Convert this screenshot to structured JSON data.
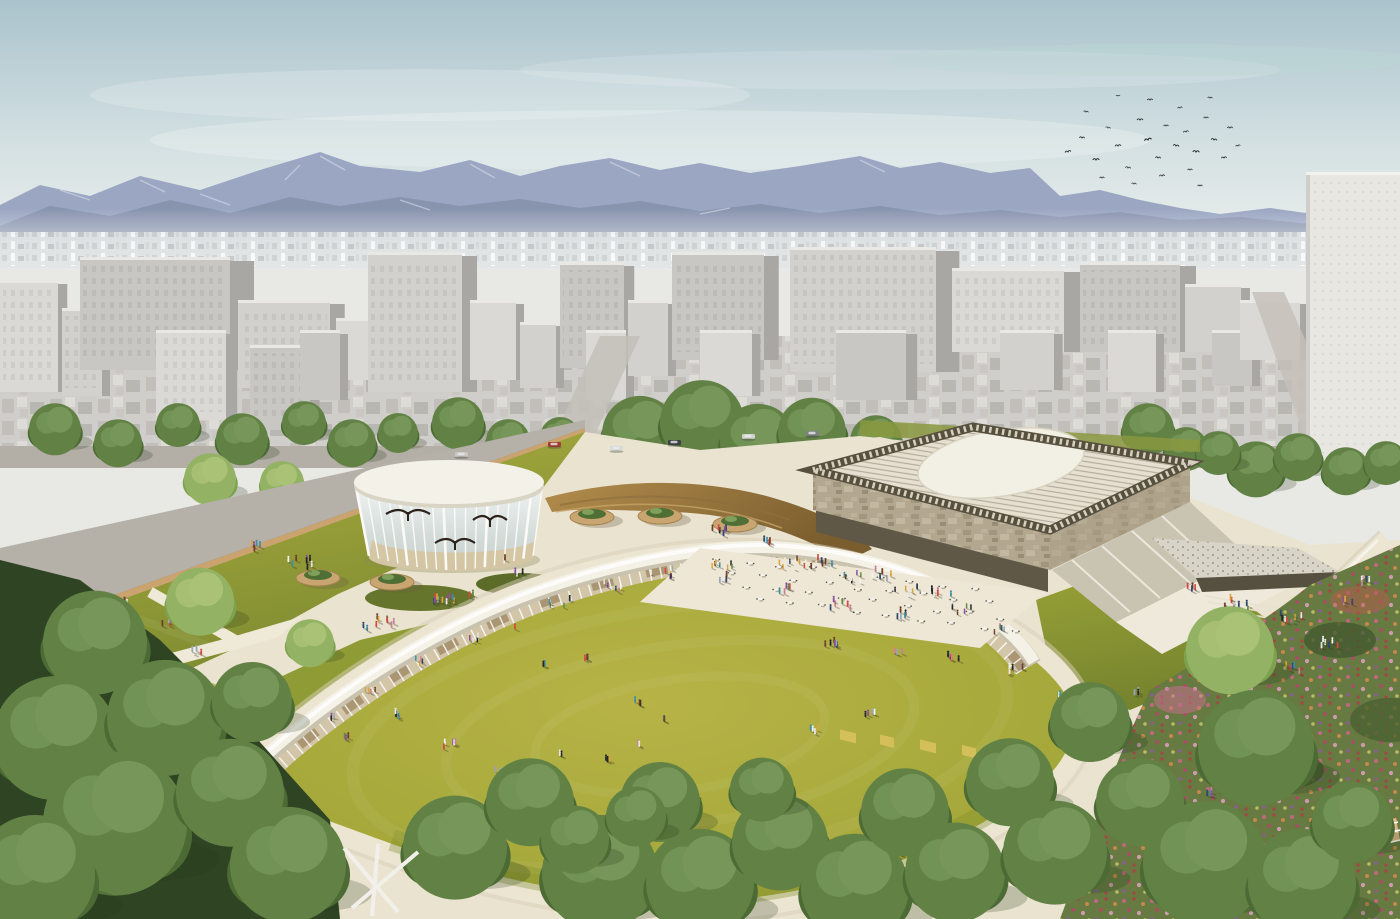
{
  "meta": {
    "width": 1400,
    "height": 919
  },
  "palette": {
    "sky_top": "#aac3cc",
    "sky_horizon": "#eef0ee",
    "mountain_far": "#9aa6c2",
    "mountain_near": "#8893ae",
    "city_face": "#d7d6d2",
    "city_side": "#a9a7a3",
    "city_lowrise": "#c9c7c2",
    "tower_right": "#e8e7e2",
    "lawn_sunken": "#a5a83a",
    "lawn_field": "#99a338",
    "green_roof": "#8f9c36",
    "plaza_cream": "#eae3cf",
    "path_cream": "#ece5d1",
    "fascia_white": "#f4f1e6",
    "gallery_glass_tan": "#d3c6a8",
    "ochre_ramp": "#a5813f",
    "museum_roof": "#e6e0d0",
    "museum_circle": "#f2efe4",
    "museum_stone": "#b3a78f",
    "truss_dark": "#57503e",
    "tree_dark": "#3f5a2c",
    "tree_mid": "#577539",
    "tree_light": "#6f8f48",
    "flower_pink": "#c9648b",
    "flower_red": "#a84343",
    "flower_orange": "#d08a4e",
    "wall_brown": "#8a7450"
  },
  "scene": {
    "people_palette": [
      "#d24a42",
      "#30476e",
      "#e8e7e3",
      "#26262b",
      "#d9a33b",
      "#5f8a49",
      "#8a4f9e",
      "#c97f97",
      "#3d8fa6",
      "#f2f2ef",
      "#6b3f27",
      "#9aa6b8"
    ],
    "city_buildings": [
      [
        0,
        58,
        280,
        392
      ],
      [
        62,
        40,
        308,
        396
      ],
      [
        80,
        150,
        257,
        370
      ],
      [
        156,
        70,
        330,
        420
      ],
      [
        238,
        92,
        300,
        388
      ],
      [
        250,
        60,
        345,
        430
      ],
      [
        336,
        34,
        318,
        380
      ],
      [
        368,
        94,
        252,
        392
      ],
      [
        300,
        40,
        330,
        400
      ],
      [
        470,
        46,
        300,
        380
      ],
      [
        520,
        36,
        322,
        388
      ],
      [
        560,
        64,
        262,
        368
      ],
      [
        586,
        40,
        330,
        400
      ],
      [
        628,
        40,
        300,
        376
      ],
      [
        672,
        92,
        252,
        360
      ],
      [
        700,
        52,
        330,
        396
      ],
      [
        790,
        146,
        247,
        372
      ],
      [
        836,
        70,
        330,
        400
      ],
      [
        952,
        112,
        268,
        352
      ],
      [
        1000,
        54,
        330,
        390
      ],
      [
        1080,
        100,
        262,
        352
      ],
      [
        1108,
        48,
        330,
        392
      ],
      [
        1185,
        56,
        284,
        352
      ],
      [
        1212,
        40,
        330,
        386
      ],
      [
        1240,
        60,
        300,
        360
      ]
    ],
    "street_trees": [
      [
        55,
        428,
        26
      ],
      [
        118,
        442,
        24
      ],
      [
        178,
        424,
        22
      ],
      [
        242,
        438,
        26
      ],
      [
        304,
        422,
        22
      ],
      [
        352,
        442,
        24
      ],
      [
        398,
        432,
        20
      ],
      [
        458,
        422,
        26
      ],
      [
        508,
        440,
        22
      ],
      [
        210,
        478,
        26,
        1
      ],
      [
        282,
        482,
        22,
        1
      ],
      [
        560,
        436,
        20
      ],
      [
        640,
        432,
        38
      ],
      [
        702,
        420,
        42
      ],
      [
        758,
        440,
        38
      ],
      [
        812,
        430,
        34
      ],
      [
        876,
        440,
        26
      ],
      [
        1148,
        428,
        26
      ],
      [
        1186,
        448,
        22
      ],
      [
        1256,
        468,
        28
      ],
      [
        1298,
        456,
        24
      ],
      [
        1218,
        452,
        22
      ],
      [
        1346,
        470,
        24
      ],
      [
        1386,
        462,
        22
      ]
    ],
    "foreground_trees": [
      [
        95,
        640,
        52
      ],
      [
        55,
        735,
        62
      ],
      [
        165,
        715,
        58
      ],
      [
        115,
        820,
        72
      ],
      [
        35,
        872,
        60
      ],
      [
        230,
        790,
        54
      ],
      [
        288,
        862,
        58
      ],
      [
        200,
        600,
        34,
        1
      ],
      [
        310,
        642,
        24,
        1
      ],
      [
        252,
        700,
        40
      ],
      [
        455,
        845,
        52
      ],
      [
        530,
        800,
        44
      ],
      [
        600,
        870,
        58
      ],
      [
        660,
        800,
        40
      ],
      [
        700,
        880,
        54
      ],
      [
        780,
        840,
        48
      ],
      [
        855,
        885,
        54
      ],
      [
        905,
        810,
        44
      ],
      [
        955,
        870,
        50
      ],
      [
        762,
        788,
        32
      ],
      [
        575,
        838,
        34
      ],
      [
        636,
        815,
        30
      ],
      [
        1010,
        780,
        44
      ],
      [
        1055,
        850,
        52
      ],
      [
        1090,
        720,
        40
      ],
      [
        1140,
        800,
        44
      ],
      [
        1230,
        648,
        44,
        1
      ],
      [
        1256,
        745,
        58
      ],
      [
        1205,
        860,
        62
      ],
      [
        1302,
        880,
        54
      ],
      [
        1352,
        820,
        40
      ]
    ],
    "birds": [
      [
        1068,
        152,
        1,
        -10
      ],
      [
        1082,
        138,
        0.9,
        5
      ],
      [
        1096,
        160,
        1.1,
        0
      ],
      [
        1108,
        128,
        0.8,
        12
      ],
      [
        1118,
        146,
        1,
        -6
      ],
      [
        1128,
        168,
        0.9,
        8
      ],
      [
        1140,
        120,
        1,
        0
      ],
      [
        1148,
        140,
        1.2,
        -12
      ],
      [
        1158,
        158,
        0.9,
        6
      ],
      [
        1166,
        126,
        0.8,
        0
      ],
      [
        1176,
        146,
        1,
        10
      ],
      [
        1186,
        132,
        0.9,
        -8
      ],
      [
        1196,
        152,
        1.1,
        4
      ],
      [
        1206,
        118,
        0.8,
        0
      ],
      [
        1214,
        140,
        1,
        8
      ],
      [
        1224,
        158,
        0.9,
        -5
      ],
      [
        1102,
        178,
        0.8,
        0
      ],
      [
        1134,
        184,
        0.8,
        6
      ],
      [
        1162,
        176,
        0.9,
        -4
      ],
      [
        1190,
        170,
        0.8,
        0
      ],
      [
        1086,
        112,
        0.8,
        8
      ],
      [
        1150,
        100,
        0.9,
        0
      ],
      [
        1180,
        108,
        0.8,
        -6
      ],
      [
        1210,
        98,
        0.8,
        4
      ],
      [
        1230,
        128,
        0.9,
        0
      ],
      [
        1118,
        96,
        0.7,
        0
      ],
      [
        1200,
        186,
        0.8,
        0
      ],
      [
        1238,
        146,
        0.8,
        -8
      ]
    ],
    "people_groups": [
      [
        300,
        560,
        8,
        26
      ],
      [
        255,
        545,
        5,
        18
      ],
      [
        120,
        598,
        4,
        14
      ],
      [
        165,
        620,
        3,
        10
      ],
      [
        440,
        598,
        5,
        16
      ],
      [
        380,
        622,
        9,
        40
      ],
      [
        520,
        570,
        3,
        10
      ],
      [
        505,
        556,
        1,
        0
      ],
      [
        470,
        592,
        2,
        6
      ],
      [
        560,
        600,
        6,
        22,
        0.85
      ],
      [
        612,
        585,
        5,
        20,
        0.85
      ],
      [
        662,
        572,
        6,
        22,
        0.85
      ],
      [
        722,
        562,
        8,
        26,
        0.85
      ],
      [
        792,
        562,
        8,
        26,
        0.85
      ],
      [
        852,
        576,
        7,
        24,
        0.85
      ],
      [
        906,
        590,
        8,
        24,
        0.85
      ],
      [
        962,
        608,
        6,
        20,
        0.85
      ],
      [
        1002,
        628,
        5,
        16,
        0.85
      ],
      [
        470,
        636,
        5,
        16,
        0.85
      ],
      [
        420,
        660,
        4,
        14,
        0.85
      ],
      [
        370,
        690,
        4,
        12,
        0.85
      ],
      [
        332,
        716,
        3,
        10,
        0.85
      ],
      [
        720,
        530,
        6,
        20
      ],
      [
        762,
        540,
        5,
        16
      ],
      [
        820,
        560,
        6,
        24
      ],
      [
        880,
        572,
        7,
        24
      ],
      [
        940,
        590,
        6,
        22
      ],
      [
        900,
        612,
        5,
        20
      ],
      [
        840,
        602,
        6,
        22
      ],
      [
        782,
        588,
        5,
        18
      ],
      [
        726,
        576,
        4,
        16
      ],
      [
        1235,
        602,
        10,
        30
      ],
      [
        1290,
        614,
        8,
        24
      ],
      [
        1330,
        640,
        6,
        18
      ],
      [
        1348,
        600,
        4,
        12
      ],
      [
        1365,
        580,
        4,
        12
      ],
      [
        1292,
        666,
        5,
        16
      ],
      [
        1262,
        702,
        4,
        14
      ],
      [
        1226,
        746,
        4,
        12
      ],
      [
        1212,
        790,
        5,
        14
      ],
      [
        1304,
        760,
        3,
        10
      ],
      [
        905,
        852,
        6,
        20
      ],
      [
        860,
        838,
        4,
        14
      ],
      [
        515,
        625,
        1,
        0
      ],
      [
        545,
        662,
        2,
        6
      ],
      [
        585,
        655,
        3,
        8
      ],
      [
        640,
        700,
        3,
        10
      ],
      [
        662,
        716,
        2,
        6
      ],
      [
        830,
        640,
        6,
        16
      ],
      [
        900,
        648,
        4,
        12
      ],
      [
        955,
        655,
        5,
        14
      ],
      [
        1015,
        668,
        6,
        16
      ],
      [
        1060,
        695,
        5,
        14
      ],
      [
        1090,
        712,
        4,
        12
      ],
      [
        870,
        712,
        4,
        12
      ],
      [
        815,
        728,
        4,
        12
      ],
      [
        640,
        742,
        2,
        6
      ],
      [
        610,
        758,
        3,
        8
      ],
      [
        560,
        752,
        2,
        6
      ],
      [
        500,
        770,
        3,
        10
      ],
      [
        450,
        742,
        5,
        14
      ],
      [
        400,
        712,
        4,
        12
      ],
      [
        345,
        735,
        3,
        10
      ],
      [
        695,
        792,
        2,
        6
      ],
      [
        745,
        822,
        4,
        12
      ],
      [
        1120,
        800,
        5,
        14
      ],
      [
        1162,
        778,
        4,
        10
      ],
      [
        985,
        780,
        3,
        8
      ],
      [
        1035,
        812,
        4,
        10
      ],
      [
        445,
        598,
        6,
        18
      ],
      [
        200,
        650,
        5,
        16
      ],
      [
        80,
        682,
        6,
        18
      ],
      [
        60,
        730,
        4,
        12
      ],
      [
        1190,
        585,
        4,
        12
      ],
      [
        1138,
        690,
        3,
        8
      ]
    ],
    "planters": [
      [
        318,
        578
      ],
      [
        392,
        582
      ],
      [
        592,
        517
      ],
      [
        660,
        516
      ],
      [
        735,
        524
      ]
    ],
    "cars": [
      [
        548,
        442,
        "#a33b34"
      ],
      [
        610,
        446,
        "#d9d9d6"
      ],
      [
        668,
        440,
        "#3c3f44"
      ],
      [
        742,
        434,
        "#d2d2cf"
      ],
      [
        806,
        431,
        "#7e8286"
      ],
      [
        455,
        452,
        "#c7c7c4"
      ]
    ],
    "cafe_tables": {
      "origin": [
        716,
        556
      ],
      "rows": 4,
      "cols": 9,
      "col_step": [
        32,
        4
      ],
      "row_step": [
        14,
        14
      ]
    },
    "pavilion": {
      "cx": 449,
      "rim_y": 482,
      "rx_top": 94,
      "ry_top": 21,
      "base_y": 556,
      "rx_base": 82,
      "ry_base": 14,
      "mullions": 17
    },
    "skeletons": [
      [
        408,
        514,
        22
      ],
      [
        490,
        520,
        17
      ],
      [
        455,
        543,
        20
      ]
    ]
  }
}
